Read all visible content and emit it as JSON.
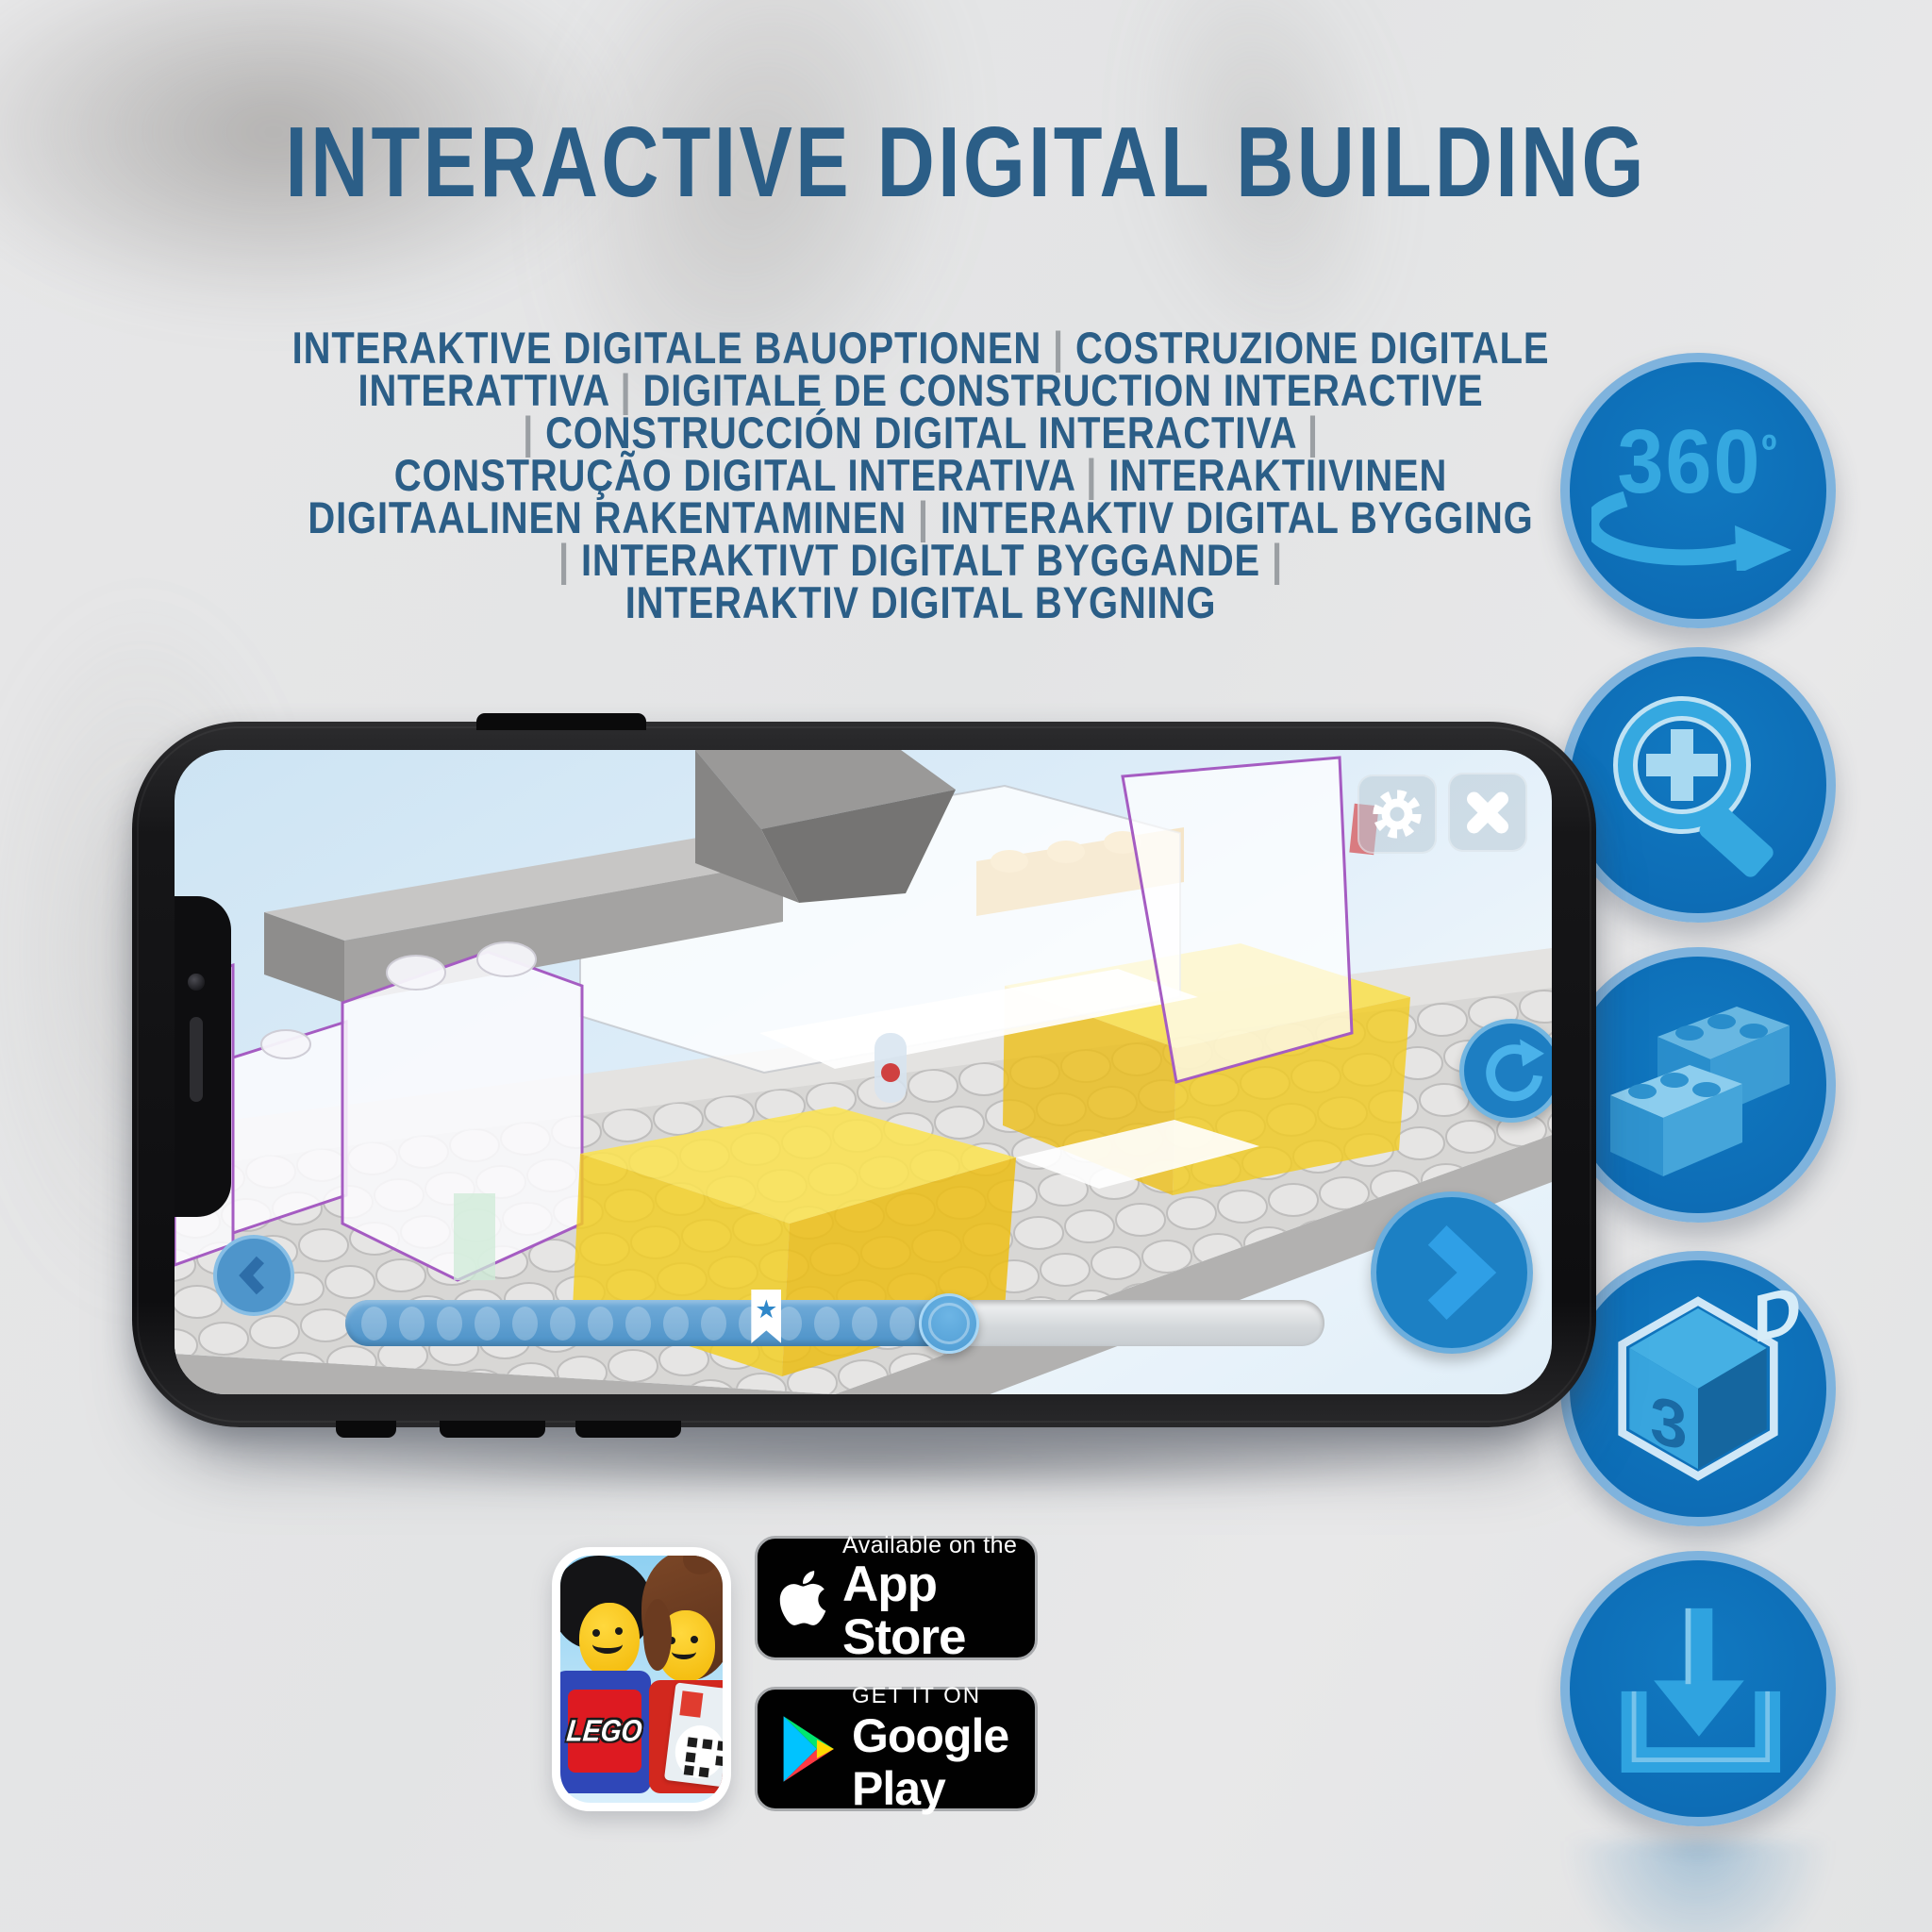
{
  "page": {
    "title": "INTERACTIVE DIGITAL BUILDING",
    "title_color": "#2b5e87",
    "background_color": "#e5e5e6",
    "subtitle_lines": [
      "INTERAKTIVE DIGITALE BAUOPTIONEN | COSTRUZIONE DIGITALE",
      "INTERATTIVA | DIGITALE DE CONSTRUCTION INTERACTIVE",
      "| CONSTRUCCIÓN DIGITAL INTERACTIVA |",
      "CONSTRUÇÃO DIGITAL INTERATIVA | INTERAKTIIVINEN",
      "DIGITAALINEN RAKENTAMINEN | INTERAKTIV DIGITAL BYGGING",
      "| INTERAKTIVT DIGITALT BYGGANDE |",
      "INTERAKTIV DIGITAL BYGNING"
    ]
  },
  "feature_icons": {
    "circle_fill": "#0f70b6",
    "circle_border": "#7fb3dd",
    "glyph_color": "#35a8e0",
    "items": [
      {
        "name": "360-rotation",
        "label": "360",
        "degree": "º"
      },
      {
        "name": "zoom-in-magnifier"
      },
      {
        "name": "lego-bricks"
      },
      {
        "name": "3d-view-cube",
        "face_left": "3",
        "face_right": "D"
      },
      {
        "name": "download"
      }
    ]
  },
  "phone": {
    "screen_ui": {
      "buttons": [
        "settings",
        "close",
        "reset-view",
        "previous-step",
        "next-step"
      ],
      "progress": {
        "steps_total": 16,
        "filled_ratio": 0.617,
        "bookmark_ratio": 0.43,
        "bookmark_icon": "★"
      }
    }
  },
  "badges": {
    "lego_app_logo": "LEGO",
    "app_store": {
      "tagline": "Available on the",
      "store_name": "App Store"
    },
    "google_play": {
      "tagline": "GET IT ON",
      "store_name": "Google Play"
    }
  }
}
